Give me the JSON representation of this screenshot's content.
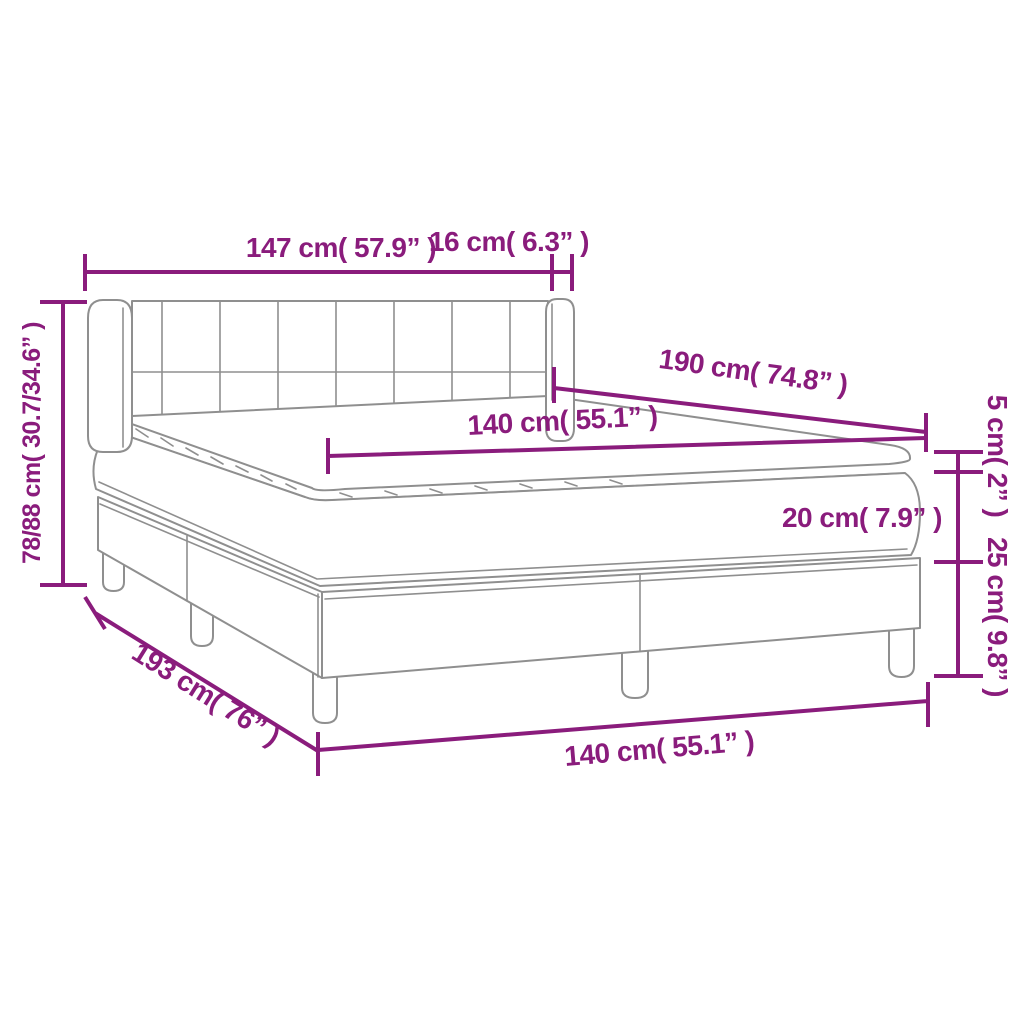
{
  "figure": {
    "type": "product-dimension-diagram",
    "subject": "box spring bed with tufted headboard, mattress and topper",
    "colors": {
      "dimension_annotations": "#8A1C7C",
      "drawing_lines": "#8F8F8F",
      "background": "#FFFFFF"
    },
    "labels": {
      "headboard_width": "147 cm( 57.9” )",
      "headboard_side_depth": "16 cm( 6.3” )",
      "overall_height": "78/88 cm( 30.7/34.6” )",
      "mattress_length": "190 cm( 74.8” )",
      "mattress_width_top": "140 cm( 55.1” )",
      "topper_thickness": "5 cm( 2” )",
      "mattress_thickness": "20 cm( 7.9” )",
      "base_height": "25 cm( 9.8” )",
      "overall_length": "193 cm( 76” )",
      "mattress_width_bottom": "140 cm( 55.1” )"
    }
  }
}
